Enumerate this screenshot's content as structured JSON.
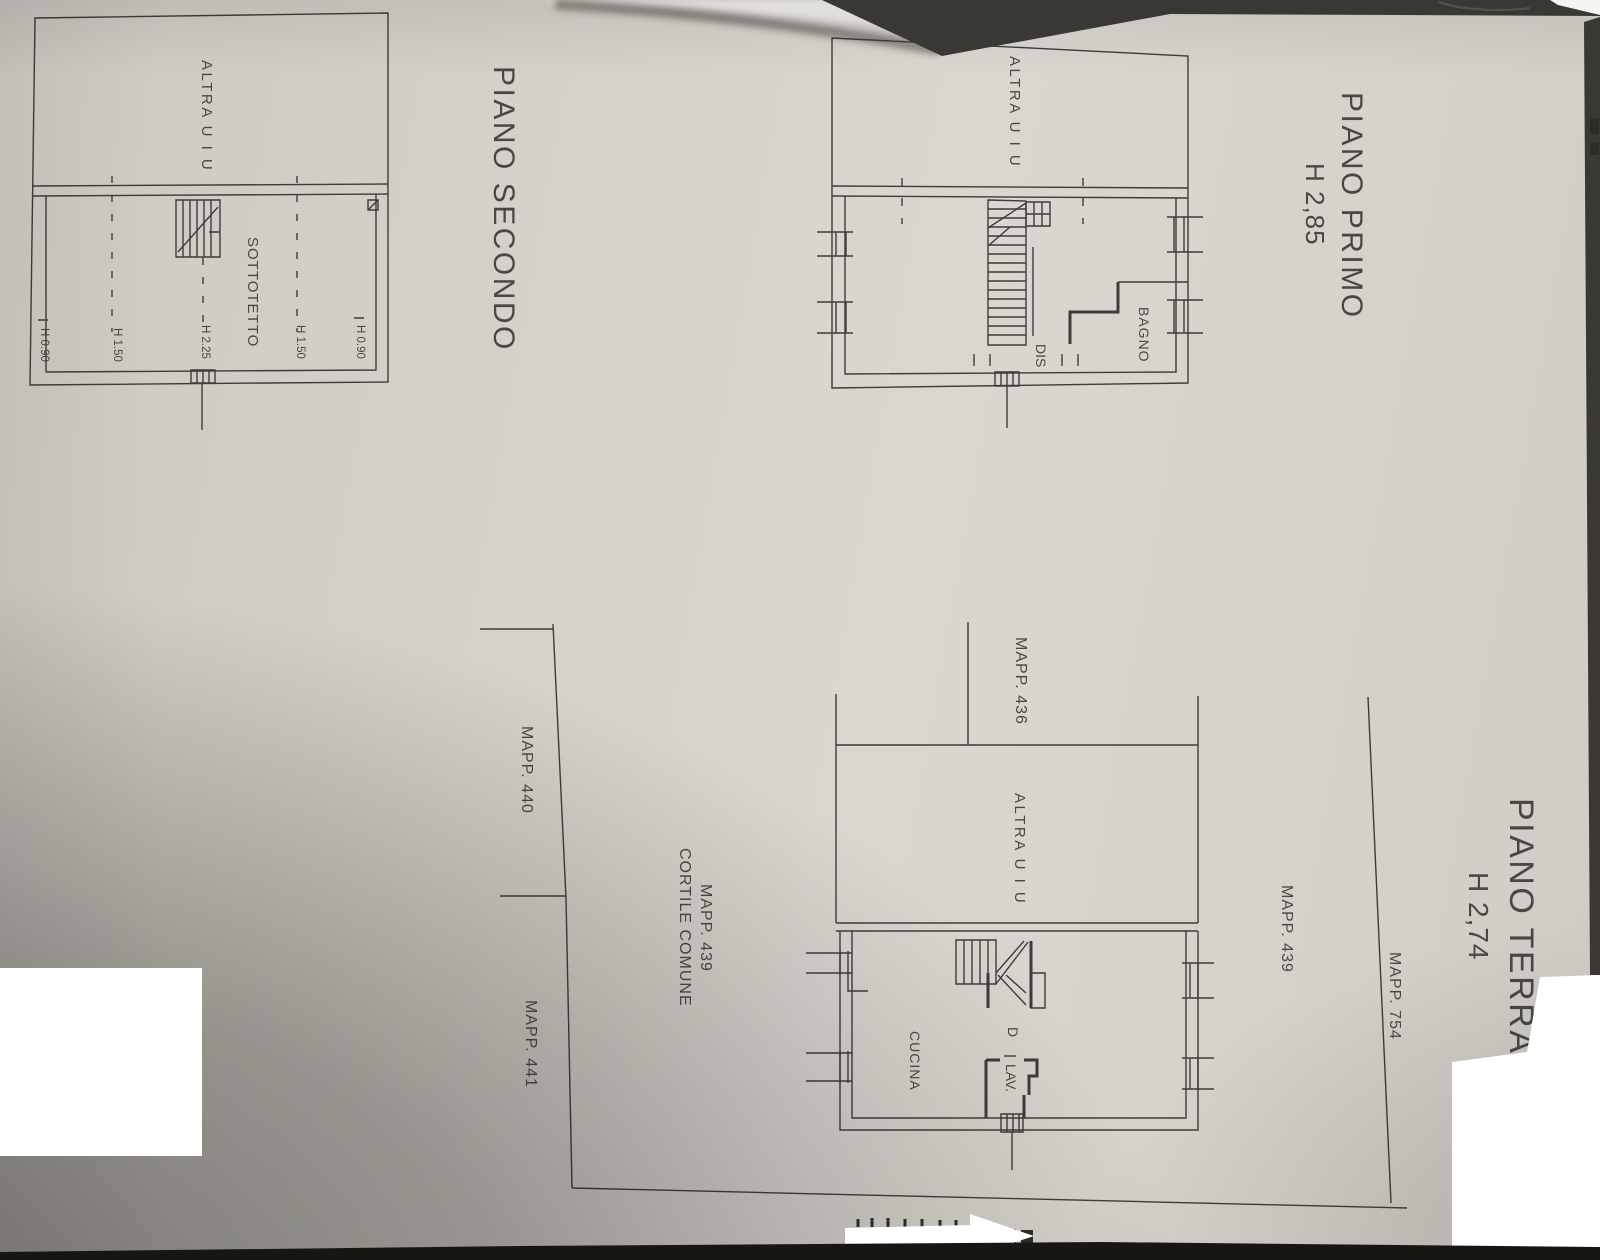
{
  "floors": {
    "secondo": {
      "title": "PIANO SECONDO",
      "unit_label": "ALTRA U I U",
      "room_label": "SOTTOTETTO",
      "heights": [
        "H 0.90",
        "H 1.50",
        "H 2.25",
        "H 1.50",
        "H 0.90"
      ]
    },
    "primo": {
      "title": "PIANO PRIMO",
      "height_label": "H 2,85",
      "unit_label": "ALTRA U I U",
      "rooms": {
        "bagno": "BAGNO",
        "disimpegno": "DIS"
      }
    },
    "terra": {
      "title": "PIANO TERRA",
      "height_label": "H 2,74",
      "unit_label": "ALTRA U I U",
      "rooms": {
        "cucina": "CUCINA",
        "disimpegno": "D",
        "lavanderia": "LAV."
      }
    }
  },
  "parcels": {
    "mapp_436": "MAPP. 436",
    "mapp_440": "MAPP. 440",
    "mapp_441": "MAPP. 441",
    "mapp_439_cortile_line1": "MAPP. 439",
    "mapp_439_cortile_line2": "CORTILE COMUNE",
    "mapp_439_right": "MAPP. 439",
    "mapp_754": "MAPP. 754"
  },
  "icons": {
    "direction_arrow": "right-arrow"
  },
  "colors": {
    "paper": "#d6d3cc",
    "ink": "#3e3c38",
    "redaction": "#ffffff",
    "shadow": "#201e1a"
  }
}
